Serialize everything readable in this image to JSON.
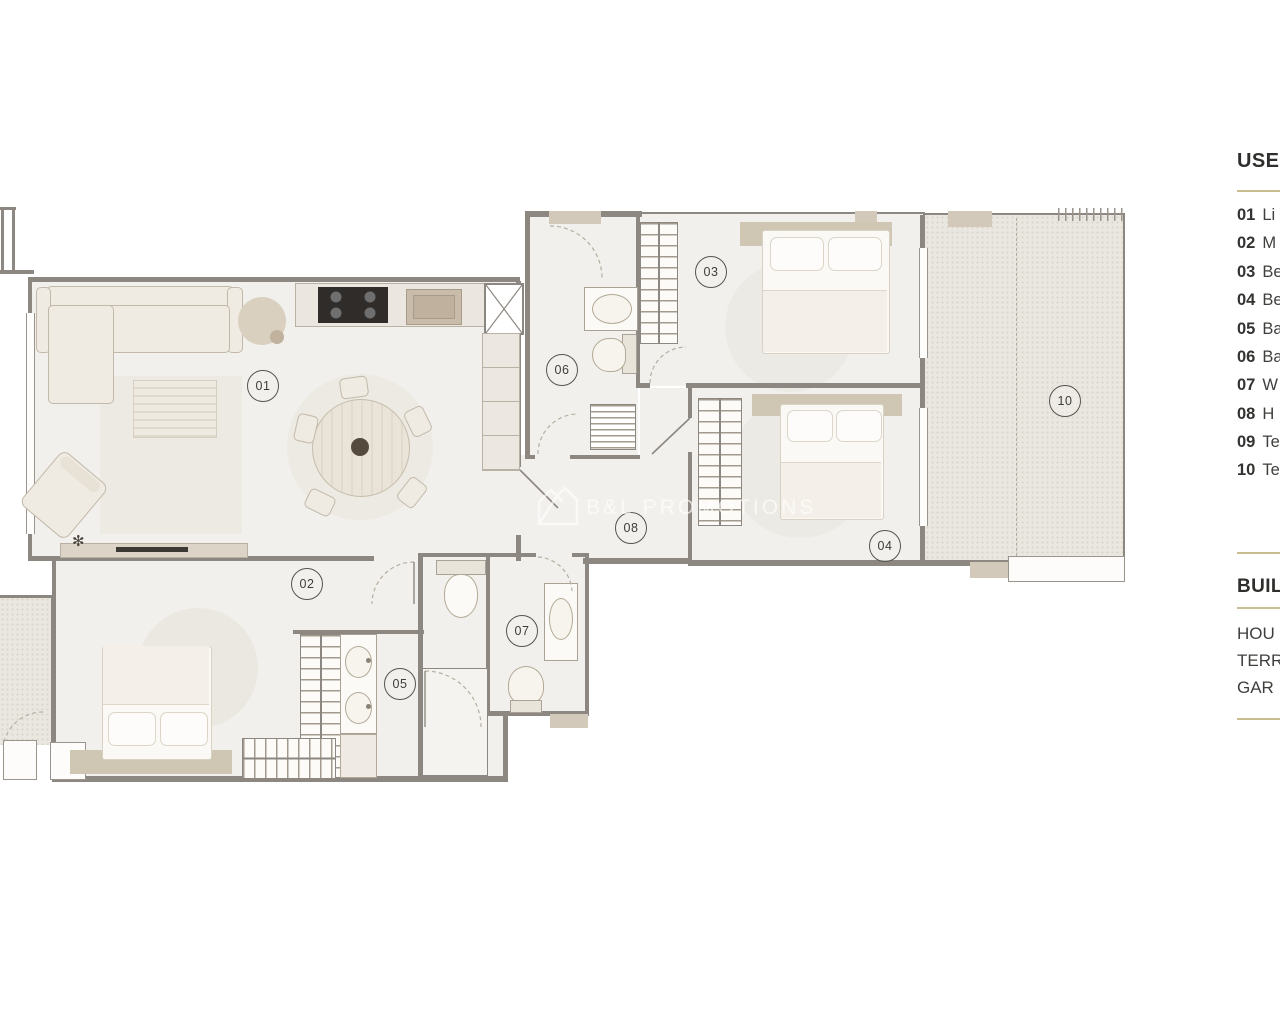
{
  "watermark": {
    "brand": "B&L PROMOTIONS",
    "icon": "house-logo-icon"
  },
  "plan": {
    "room_labels": {
      "r01": "01",
      "r02": "02",
      "r03": "03",
      "r04": "04",
      "r05": "05",
      "r06": "06",
      "r07": "07",
      "r08": "08",
      "r10": "10"
    }
  },
  "legend": {
    "useful_title": "USEF",
    "items": [
      {
        "num": "01",
        "label": "Li"
      },
      {
        "num": "02",
        "label": "M"
      },
      {
        "num": "03",
        "label": "Be"
      },
      {
        "num": "04",
        "label": "Be"
      },
      {
        "num": "05",
        "label": "Ba"
      },
      {
        "num": "06",
        "label": "Ba"
      },
      {
        "num": "07",
        "label": "W"
      },
      {
        "num": "08",
        "label": "H"
      },
      {
        "num": "09",
        "label": "Te"
      },
      {
        "num": "10",
        "label": "Te"
      }
    ],
    "built_title": "BUIL",
    "built_items": [
      {
        "label": "HOU"
      },
      {
        "label": "TERR"
      },
      {
        "label": "GAR"
      }
    ]
  },
  "colors": {
    "accent_rule": "#c9bd92",
    "wall": "#8d8781",
    "terrace": "#eae7e1",
    "floor": "#f2f0ec"
  }
}
